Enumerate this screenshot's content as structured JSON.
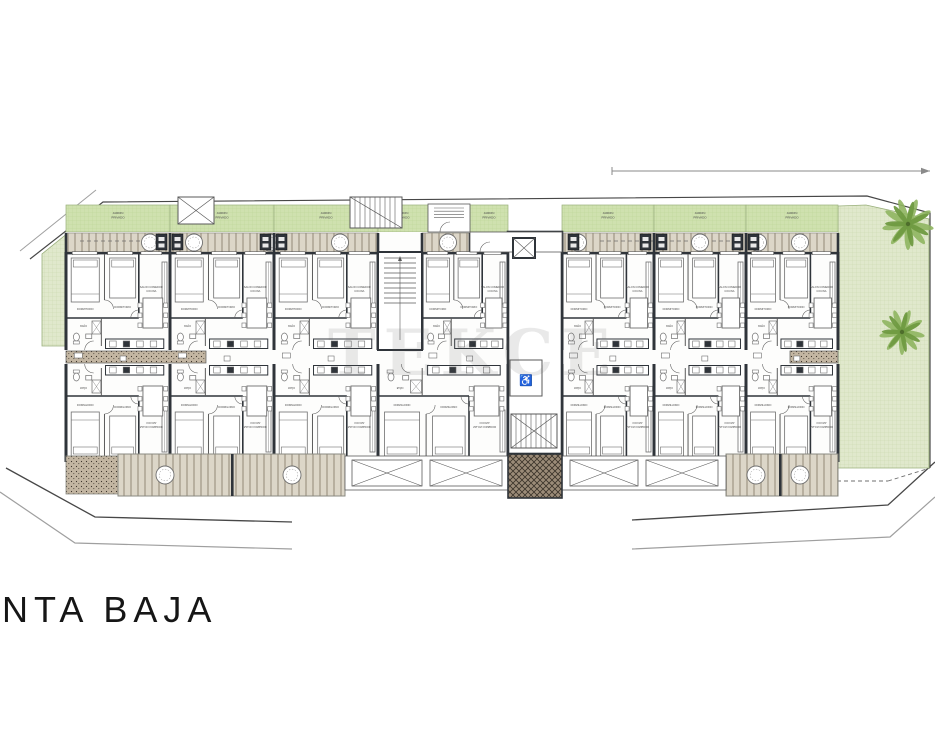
{
  "plan": {
    "level_label": "NTA BAJA",
    "watermark_text": "TEKCE",
    "labels": {
      "garden_l1": "JARDIN",
      "garden_l2": "PRIVADO",
      "bedroom": "DORMITORIO",
      "living_l1": "SALON COMEDOR",
      "living_l2": "COCINA",
      "bath": "BAÑO",
      "terrace": "TERRAZA"
    },
    "upper_units": [
      {
        "x": 66,
        "w": 104
      },
      {
        "x": 170,
        "w": 104
      },
      {
        "x": 274,
        "w": 104
      },
      {
        "x": 422,
        "w": 86
      },
      {
        "x": 562,
        "w": 92
      },
      {
        "x": 654,
        "w": 92
      },
      {
        "x": 746,
        "w": 92
      }
    ],
    "lower_units": [
      {
        "x": 66,
        "w": 104
      },
      {
        "x": 170,
        "w": 104
      },
      {
        "x": 274,
        "w": 104
      },
      {
        "x": 378,
        "w": 130
      },
      {
        "x": 562,
        "w": 92
      },
      {
        "x": 654,
        "w": 92
      },
      {
        "x": 746,
        "w": 92
      }
    ],
    "garden_cells": [
      [
        66,
        170
      ],
      [
        170,
        274
      ],
      [
        274,
        378
      ],
      [
        378,
        428
      ],
      [
        470,
        508
      ],
      [
        562,
        654
      ],
      [
        654,
        746
      ],
      [
        746,
        838
      ]
    ],
    "terrace_segments": [
      [
        66,
        378
      ],
      [
        422,
        505
      ],
      [
        562,
        838
      ]
    ],
    "upper_tables": [
      150,
      194,
      270,
      340,
      448,
      486,
      578,
      700,
      758,
      800
    ],
    "storage_box_walls": [
      170,
      274,
      566,
      654,
      746
    ],
    "bottom_tables": [
      165,
      292,
      756,
      800
    ],
    "palms": [
      {
        "x": 908,
        "y": 224,
        "r": 26
      },
      {
        "x": 902,
        "y": 332,
        "r": 23
      }
    ],
    "dimension_line": {
      "x1": 612,
      "x2": 930,
      "y": 171
    }
  },
  "palette": {
    "paper": "#ffffff",
    "line": "#5a5a5a",
    "wall": "#2f343a",
    "furn": "#6f6f6f",
    "tinyText": "#4c4c4c",
    "gardenFill": "#e0e8cc",
    "gardenGrid": "#c9d6ac",
    "gardenEdge": "#9ab07c",
    "cellFill": "#cfe1af",
    "cellGrid": "#bad395",
    "deckBase": "#dcd6c8",
    "deckStripe": "#b7af9f",
    "deckEdge": "#8a8a82",
    "matBase": "#9b8b78",
    "matLine": "#3b332a",
    "speckBase": "#c3b6a2",
    "palmDark": "#6f9a41",
    "palmLight": "#8fb561",
    "boundary": "#474747",
    "boundaryLight": "#9f9f9f",
    "dim": "#8a8a8a"
  }
}
